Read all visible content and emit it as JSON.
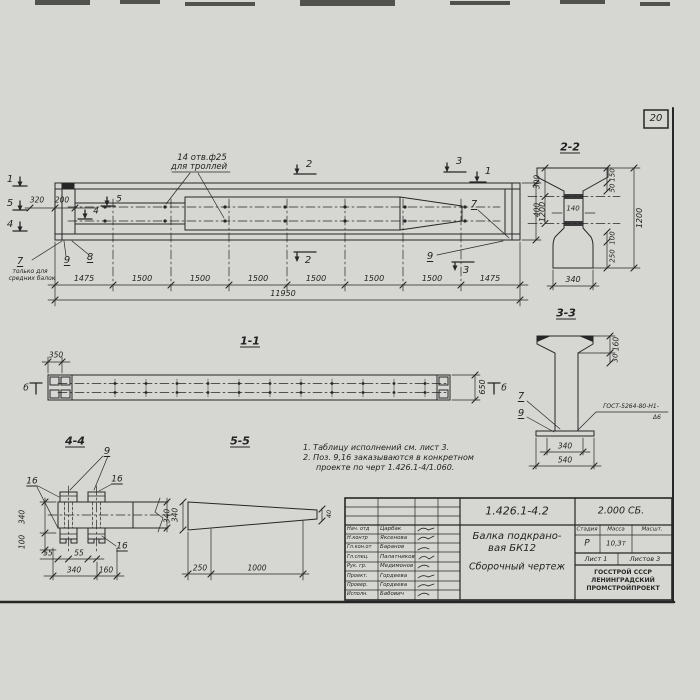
{
  "sheet": {
    "page_number": "20"
  },
  "plan": {
    "holes_note_1": "14 отв.ф25",
    "holes_note_2": "для троллей",
    "mark_1": "1",
    "mark_2": "2",
    "mark_3": "3",
    "mark_4": "4",
    "mark_5": "5",
    "mark_2b": "2",
    "mark_3b": "3",
    "mark_1r": "1",
    "mark_5i": "5",
    "mark_4i": "4",
    "callout_7": "7",
    "callout_8": "8",
    "callout_9": "9",
    "callout_7r": "7",
    "callout_9r": "9",
    "left_note_1": "только для",
    "left_note_2": "средних балок",
    "dim_320": "320",
    "dim_200": "200",
    "dim_1200": "1200",
    "segments": [
      "1475",
      "1500",
      "1500",
      "1500",
      "1500",
      "1500",
      "1500",
      "1475"
    ],
    "dim_total": "11950"
  },
  "sec11": {
    "label": "1-1",
    "dim_350": "350",
    "dim_650": "650",
    "mark_left": "б",
    "mark_right": "б"
  },
  "sec22": {
    "label": "2-2",
    "dim_300": "300",
    "dim_400": "400",
    "dim_150": "150",
    "dim_50": "50",
    "dim_140": "140",
    "dim_1200": "1200",
    "dim_100": "100",
    "dim_250": "250",
    "dim_340": "340"
  },
  "sec33": {
    "label": "3-3",
    "dim_160": "160",
    "dim_30": "30",
    "dim_340": "340",
    "dim_540": "540",
    "callout_7": "7",
    "callout_9": "9",
    "weld_note_1": "ГОСТ-5264-80-Н1-",
    "weld_note_2": "Δ6"
  },
  "v44": {
    "label": "4-4",
    "callout_9": "9",
    "callout_16a": "16",
    "callout_16b": "16",
    "callout_16c": "16",
    "dim_340l": "340",
    "dim_100": "100",
    "dim_55a": "55",
    "dim_55b": "55",
    "dim_340b": "340",
    "dim_160": "160",
    "dim_340r": "340"
  },
  "v55": {
    "label": "5-5",
    "dim_340": "340",
    "dim_250": "250",
    "dim_1000": "1000",
    "dim_40": "40"
  },
  "notes": {
    "line_1": "1. Таблицу исполнений см. лист 3.",
    "line_2": "2. Поз. 9,16 заказываются в конкретном",
    "line_3": "проекте по черт 1.426.1-4/1.060."
  },
  "titleblock": {
    "doc_number": "1.426.1-4.2",
    "doc_code": "2.000 СБ.",
    "title_1": "Балка подкрано-",
    "title_2": "вая БК12",
    "title_3": "Сборочный чертеж",
    "rows": [
      {
        "role": "Нач. отд",
        "name": "Царбак"
      },
      {
        "role": "Н.контр",
        "name": "Яксенова"
      },
      {
        "role": "Гл.кон.от",
        "name": "Баранов"
      },
      {
        "role": "Гл.спец.",
        "name": "Палатников"
      },
      {
        "role": "Рук. гр.",
        "name": "Медимонов"
      },
      {
        "role": "Проект.",
        "name": "Гордеева"
      },
      {
        "role": "Провер.",
        "name": "Гордеева"
      },
      {
        "role": "Исполн.",
        "name": "Бабович"
      }
    ],
    "stage_header": "Стадия",
    "mass_header": "Масса",
    "scale_header": "Масшт.",
    "stage": "Р",
    "mass": "10,3т",
    "sheet_label": "Лист 1",
    "sheets_label": "Листов 3",
    "org_1": "ГОССТРОЙ СССР",
    "org_2": "ЛЕНИНГРАДСКИЙ",
    "org_3": "ПРОМСТРОЙПРОЕКТ"
  }
}
